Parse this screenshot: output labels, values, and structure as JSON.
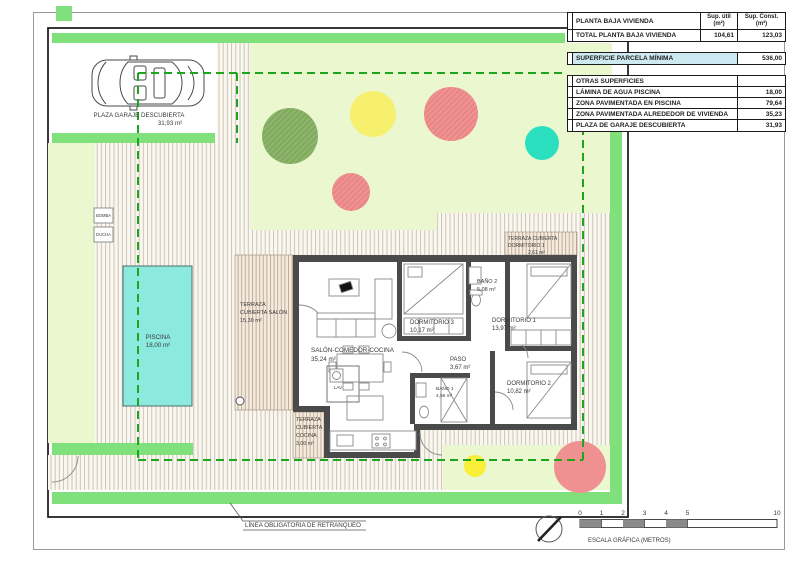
{
  "palette": {
    "strip_green": "#7fe07c",
    "lawn_green": "#eaf7cf",
    "setback_green": "#1ea51e",
    "pool_cyan": "#8be9de",
    "tree_green": "#8cb56b",
    "tree_yellow": "#f6f06e",
    "tree_red": "#f09191",
    "tree_teal": "#2ce0bf",
    "bright_yellow": "#f9ee38",
    "wall_gray": "#4a4a4a",
    "highlight_blue": "#cfe9f3"
  },
  "table": {
    "header": {
      "title": "PLANTA BAJA VIVIENDA",
      "col_util_1": "Sup. útil",
      "col_util_2": "(m²)",
      "col_const_1": "Sup. Const.",
      "col_const_2": "(m²)"
    },
    "total": {
      "label": "TOTAL PLANTA BAJA VIVIENDA",
      "util": "104,61",
      "const": "123,03"
    },
    "parcela": {
      "label": "SUPERFICIE PARCELA MÍNIMA",
      "value": "536,00"
    },
    "otras": {
      "title": "OTRAS SUPERFICIES",
      "rows": [
        {
          "label": "LÁMINA DE AGUA PISCINA",
          "value": "18,00"
        },
        {
          "label": "ZONA PAVIMENTADA EN PISCINA",
          "value": "79,64"
        },
        {
          "label": "ZONA PAVIMENTADA ALREDEDOR DE VIVIENDA",
          "value": "35,23"
        },
        {
          "label": "PLAZA DE GARAJE DESCUBIERTA",
          "value": "31,93"
        }
      ]
    }
  },
  "plan": {
    "garage": {
      "lines": [
        "PLAZA GARAJE DESCUBIERTA",
        "31,93 m²"
      ]
    },
    "piscina": {
      "lines": [
        "PISCINA",
        "18,00 m²"
      ]
    },
    "bomba": "BOMBA",
    "ducha": "DUCHA",
    "terraza_salon": {
      "lines": [
        "TERRAZA",
        "CUBIERTA SALÓN",
        "15,30 m²"
      ]
    },
    "terraza_cocina": {
      "lines": [
        "TERRAZA",
        "CUBIERTA",
        "COCINA",
        "3,00 m²"
      ]
    },
    "terraza_dorm1": {
      "lines": [
        "TERRAZA CUBIERTA",
        "DORMITORIO 1",
        "2,61 m²"
      ]
    },
    "salon": {
      "lines": [
        "SALÓN-COMEDOR-COCINA",
        "35,24 m²"
      ]
    },
    "dorm1": {
      "lines": [
        "DORMITORIO 1",
        "13,97 m²"
      ]
    },
    "dorm2": {
      "lines": [
        "DORMITORIO 2",
        "10,82 m²"
      ]
    },
    "dorm3": {
      "lines": [
        "DORMITORIO 3",
        "10,17 m²"
      ]
    },
    "paso": {
      "lines": [
        "PASO",
        "3,67 m²"
      ]
    },
    "bano1": {
      "lines": [
        "BAÑO 1",
        "4,56 m²"
      ]
    },
    "bano2": {
      "lines": [
        "BAÑO 2",
        "5,08 m²"
      ]
    },
    "lav": "LAV",
    "setback_label": "LÍNEA OBLIGATORIA DE RETRANQUEO"
  },
  "scale_bar": {
    "ticks": [
      "0",
      "1",
      "2",
      "3",
      "4",
      "5",
      "10"
    ],
    "label": "ESCALA GRÁFICA (METROS)"
  }
}
